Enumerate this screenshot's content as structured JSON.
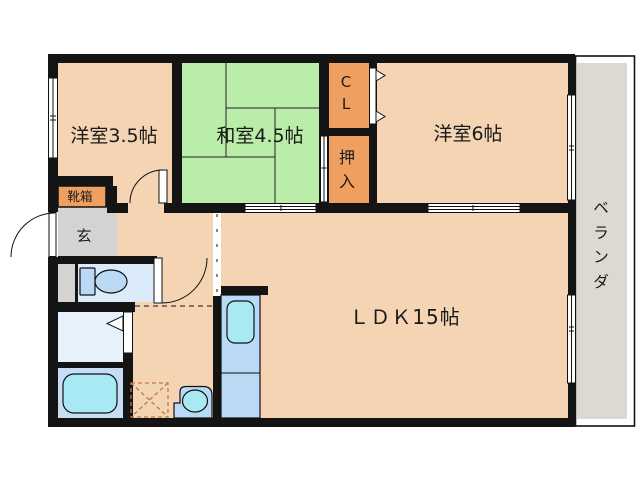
{
  "rooms": {
    "western_room_3_5": {
      "label": "洋室3.5帖"
    },
    "japanese_room_4_5": {
      "label": "和室4.5帖"
    },
    "western_room_6": {
      "label": "洋室6帖"
    },
    "ldk": {
      "label": "ＬＤＫ15帖"
    },
    "closet_cl": {
      "chars": [
        "C",
        "L"
      ]
    },
    "oshiire": {
      "chars": [
        "押",
        "入"
      ]
    },
    "shoe_box": {
      "label": "靴箱"
    },
    "entrance": {
      "label": "玄"
    },
    "veranda": {
      "chars": [
        "ベ",
        "ラ",
        "ン",
        "ダ"
      ]
    }
  },
  "colors": {
    "floor": "#f4d4b3",
    "tatami": "#b9eda9",
    "closet_orange": "#efa061",
    "entry_gray": "#d3d3d3",
    "veranda_gray": "#ddd8d1",
    "veranda_bg": "#ffffff",
    "toilet_room_blue": "#dcebfa",
    "washroom_blue": "#e6f1fb",
    "bathroom_blue": "#c5def3",
    "fixture_blue": "#bad9f5",
    "water_cyan": "#a8e9f3"
  }
}
